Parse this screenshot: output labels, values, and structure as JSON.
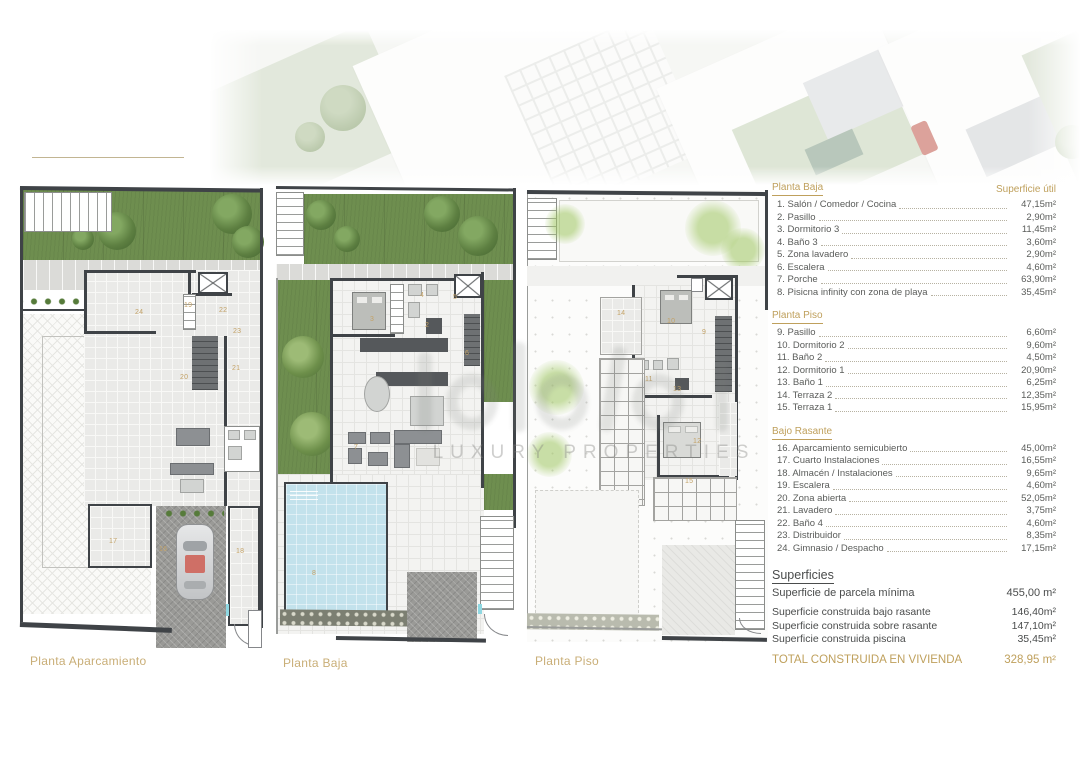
{
  "colors": {
    "gold": "#bfa05c",
    "gold_light": "#c9ae77",
    "wall": "#3f4347",
    "grass": "#6e8e4f",
    "pool": "#c3e2ec"
  },
  "watermark": {
    "subtitle": "LUXURY PROPERTIES"
  },
  "plans": {
    "aparcamiento": {
      "caption": "Planta Aparcamiento",
      "rooms": [
        {
          "n": "24",
          "x": 121,
          "y": 127
        },
        {
          "n": "22",
          "x": 205,
          "y": 125
        },
        {
          "n": "23",
          "x": 219,
          "y": 146
        },
        {
          "n": "19",
          "x": 170,
          "y": 120
        },
        {
          "n": "20",
          "x": 166,
          "y": 192
        },
        {
          "n": "21",
          "x": 218,
          "y": 183
        },
        {
          "n": "17",
          "x": 95,
          "y": 356
        },
        {
          "n": "16",
          "x": 145,
          "y": 364
        },
        {
          "n": "18",
          "x": 222,
          "y": 366
        }
      ]
    },
    "baja": {
      "caption": "Planta Baja",
      "rooms": [
        {
          "n": "3",
          "x": 100,
          "y": 134
        },
        {
          "n": "4",
          "x": 150,
          "y": 110
        },
        {
          "n": "5",
          "x": 183,
          "y": 112
        },
        {
          "n": "2",
          "x": 155,
          "y": 140
        },
        {
          "n": "6",
          "x": 195,
          "y": 168
        },
        {
          "n": "7",
          "x": 84,
          "y": 262
        },
        {
          "n": "8",
          "x": 42,
          "y": 388
        }
      ]
    },
    "piso": {
      "caption": "Planta Piso",
      "rooms": [
        {
          "n": "14",
          "x": 96,
          "y": 124
        },
        {
          "n": "10",
          "x": 146,
          "y": 132
        },
        {
          "n": "9",
          "x": 181,
          "y": 143
        },
        {
          "n": "11",
          "x": 124,
          "y": 190
        },
        {
          "n": "13",
          "x": 152,
          "y": 200
        },
        {
          "n": "12",
          "x": 172,
          "y": 252
        },
        {
          "n": "15",
          "x": 164,
          "y": 292
        }
      ]
    }
  },
  "legend": {
    "sections": [
      {
        "title": "Planta Baja",
        "title_right": "Superficie útil",
        "items": [
          {
            "label": "1. Salón / Comedor / Cocina",
            "value": "47,15m²"
          },
          {
            "label": "2. Pasillo",
            "value": "2,90m²"
          },
          {
            "label": "3. Dormitorio 3",
            "value": "11,45m²"
          },
          {
            "label": "4. Baño 3",
            "value": "3,60m²"
          },
          {
            "label": "5. Zona lavadero",
            "value": "2,90m²"
          },
          {
            "label": "6. Escalera",
            "value": "4,60m²"
          },
          {
            "label": "7. Porche",
            "value": "63,90m²"
          },
          {
            "label": "8. Pisicna infinity con zona de playa",
            "value": "35,45m²"
          }
        ]
      },
      {
        "title": "Planta Piso",
        "items": [
          {
            "label": "9. Pasillo",
            "value": "6,60m²"
          },
          {
            "label": "10. Dormitorio 2",
            "value": "9,60m²"
          },
          {
            "label": "11. Baño 2",
            "value": "4,50m²"
          },
          {
            "label": "12. Dormitorio 1",
            "value": "20,90m²"
          },
          {
            "label": "13. Baño 1",
            "value": "6,25m²"
          },
          {
            "label": "14. Terraza 2",
            "value": "12,35m²"
          },
          {
            "label": "15. Terraza 1",
            "value": "15,95m²"
          }
        ]
      },
      {
        "title": "Bajo Rasante",
        "items": [
          {
            "label": "16. Aparcamiento semicubierto",
            "value": "45,00m²"
          },
          {
            "label": "17. Cuarto Instalaciones",
            "value": "16,55m²"
          },
          {
            "label": "18. Almacén / Instalaciones",
            "value": "9,65m²"
          },
          {
            "label": "19. Escalera",
            "value": "4,60m²"
          },
          {
            "label": "20. Zona abierta",
            "value": "52,05m²"
          },
          {
            "label": "21. Lavadero",
            "value": "3,75m²"
          },
          {
            "label": "22. Baño 4",
            "value": "4,60m²"
          },
          {
            "label": "23. Distribuidor",
            "value": "8,35m²"
          },
          {
            "label": "24. Gimnasio / Despacho",
            "value": "17,15m²"
          }
        ]
      }
    ],
    "superficies": {
      "title": "Superficies",
      "primary": {
        "label": "Superficie de parcela mínima",
        "value": "455,00 m²"
      },
      "rows": [
        {
          "label": "Superficie construida bajo rasante",
          "value": "146,40m²"
        },
        {
          "label": "Superficie construida sobre rasante",
          "value": "147,10m²"
        },
        {
          "label": "Superficie construida piscina",
          "value": "35,45m²"
        }
      ],
      "total": {
        "label": "TOTAL CONSTRUIDA EN VIVIENDA",
        "value": "328,95 m²"
      }
    }
  }
}
